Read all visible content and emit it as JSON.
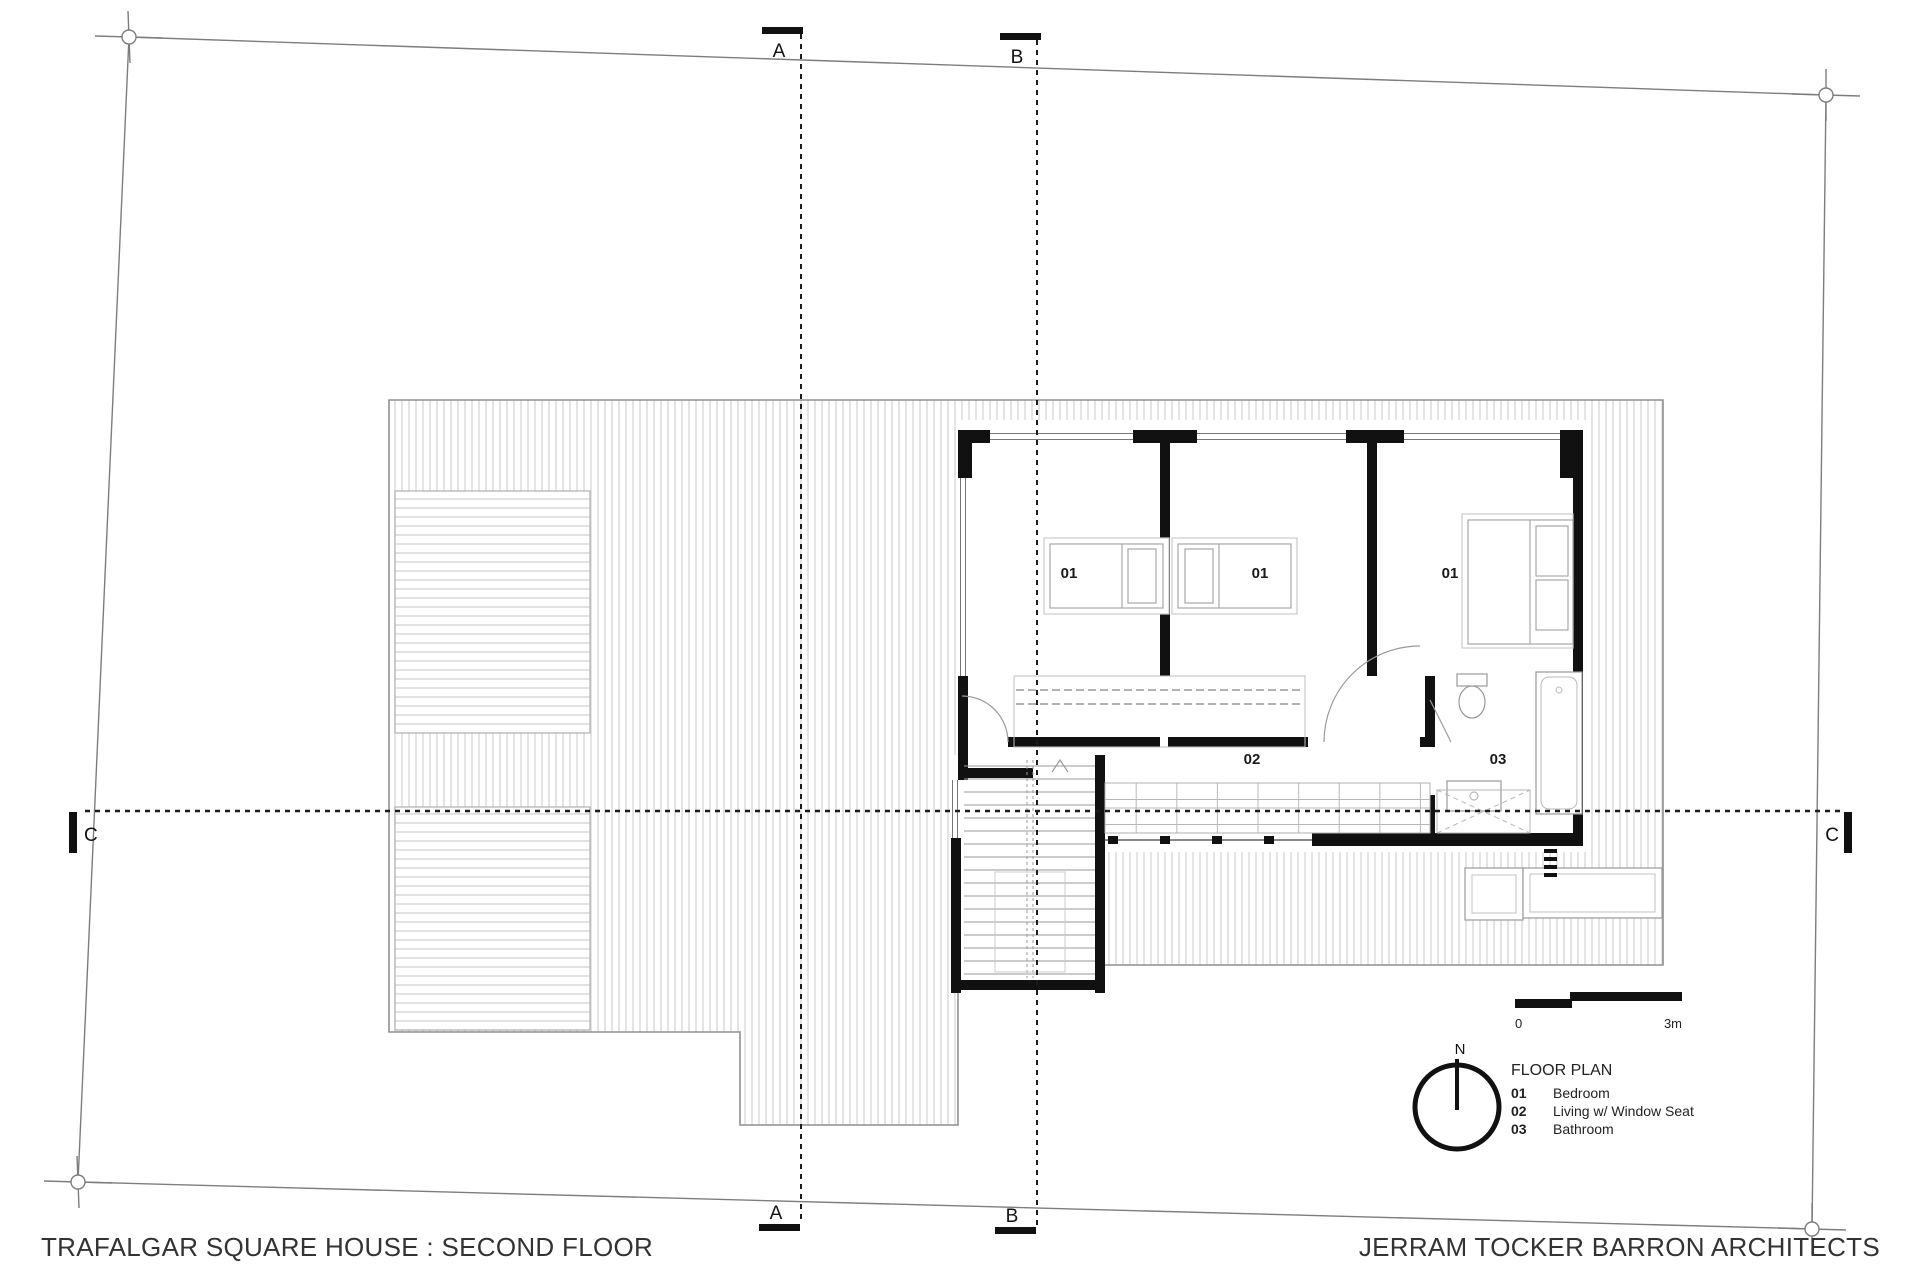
{
  "titles": {
    "project": "TRAFALGAR SQUARE HOUSE : SECOND FLOOR",
    "firm": "JERRAM TOCKER BARRON ARCHITECTS"
  },
  "legend": {
    "title": "FLOOR PLAN",
    "items": [
      {
        "code": "01",
        "label": "Bedroom"
      },
      {
        "code": "02",
        "label": "Living w/ Window Seat"
      },
      {
        "code": "03",
        "label": "Bathroom"
      }
    ]
  },
  "north_arrow": {
    "label": "N"
  },
  "scale_bar": {
    "start": "0",
    "end": "3m"
  },
  "section_markers": {
    "a": "A",
    "b": "B",
    "c": "C"
  },
  "room_labels": {
    "bedroom_left": "01",
    "bedroom_middle": "01",
    "bedroom_right": "01",
    "living": "02",
    "bathroom": "03"
  },
  "colors": {
    "wall": "#111111",
    "boundary": "#7d7d7d",
    "deck_stripe": "#d9d9d9",
    "louvre_stripe": "#cfcfcf",
    "furniture": "#a8a8a8",
    "section_line": "#1c1c1c",
    "text": "#2e2e2e"
  }
}
